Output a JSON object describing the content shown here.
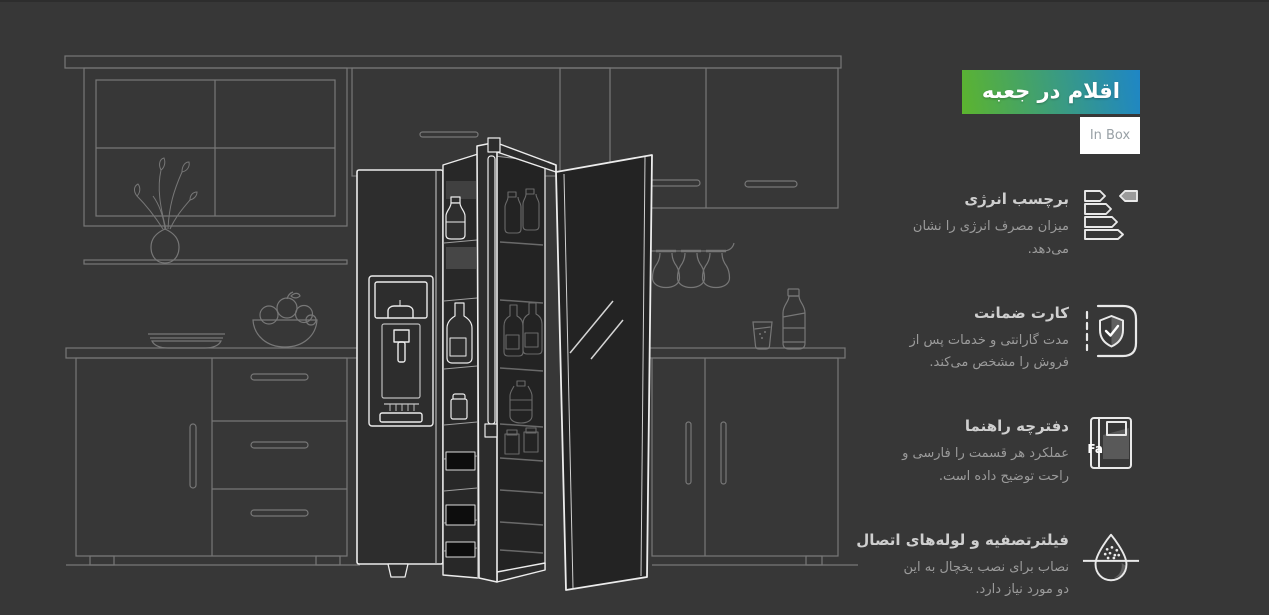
{
  "theme": {
    "background": "#373737",
    "badge_gradient_start": "#5cb42e",
    "badge_gradient_end": "#1e86c6",
    "badge_text_color": "#ffffff",
    "inbox_bg": "#ffffff",
    "inbox_text_color": "#99a1a6",
    "title_color": "#cfcfcf",
    "description_color": "#9b9b9b",
    "icon_color": "#e9e9e9",
    "artwork_line_color": "#777777",
    "fridge_line_color": "#ececec"
  },
  "header": {
    "badge_label": "اقلام در جعبه",
    "badge_sublabel": "In Box"
  },
  "items": [
    {
      "icon": "energy-label-icon",
      "title": "برچسب انرژی",
      "description": "میزان مصرف انرژی را نشان می‌دهد."
    },
    {
      "icon": "warranty-card-icon",
      "title": "کارت ضمانت",
      "description": "مدت گارانتی و خدمات پس از فروش را مشخص می‌کند."
    },
    {
      "icon": "manual-book-icon",
      "icon_text": "Fa",
      "title": "دفترچه راهنما",
      "description": "عملکرد هر قسمت را فارسی و راحت توضیح داده است."
    },
    {
      "icon": "filter-pipes-icon",
      "title": "فیلترتصفیه و لوله‌های اتصال",
      "description": "نصاب برای نصب یخچال به این دو مورد نیاز دارد."
    }
  ],
  "illustration": {
    "name": "kitchen-with-side-by-side-refrigerator-line-art"
  }
}
